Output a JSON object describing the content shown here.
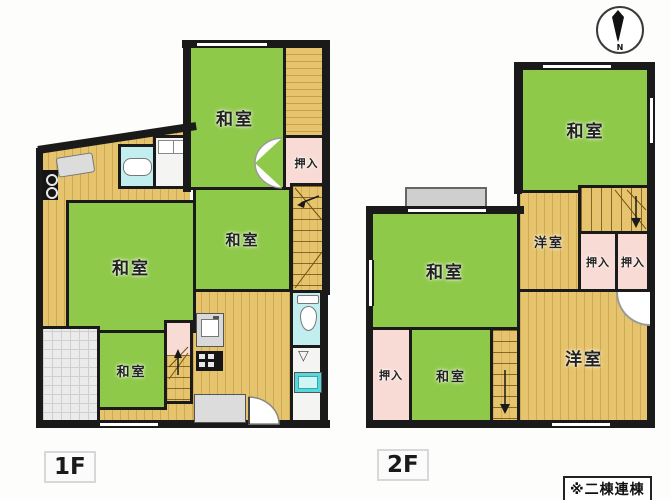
{
  "note": "※二棟連棟",
  "compass": {
    "label": "N"
  },
  "colors": {
    "wall": "#1a1a1a",
    "tatami_green": "#8fc94a",
    "wood_floor": "#e6c46d",
    "closet_pink": "#f8dbd5",
    "bath_cyan": "#c2eef0",
    "basin_teal": "#59d6dc",
    "tile_gray": "#ebebeb"
  },
  "floors": [
    {
      "label": "1F",
      "rooms": {
        "washitsu_top": "和室",
        "oshiire": "押入",
        "washitsu_mid": "和室",
        "washitsu_left": "和室",
        "washitsu_small": "和室"
      }
    },
    {
      "label": "2F",
      "rooms": {
        "washitsu_top": "和室",
        "yoshitsu_small": "洋室",
        "oshiire_a": "押入",
        "oshiire_b": "押入",
        "washitsu_left": "和室",
        "oshiire_left": "押入",
        "washitsu_small": "和室",
        "yoshitsu_main": "洋室"
      }
    }
  ]
}
